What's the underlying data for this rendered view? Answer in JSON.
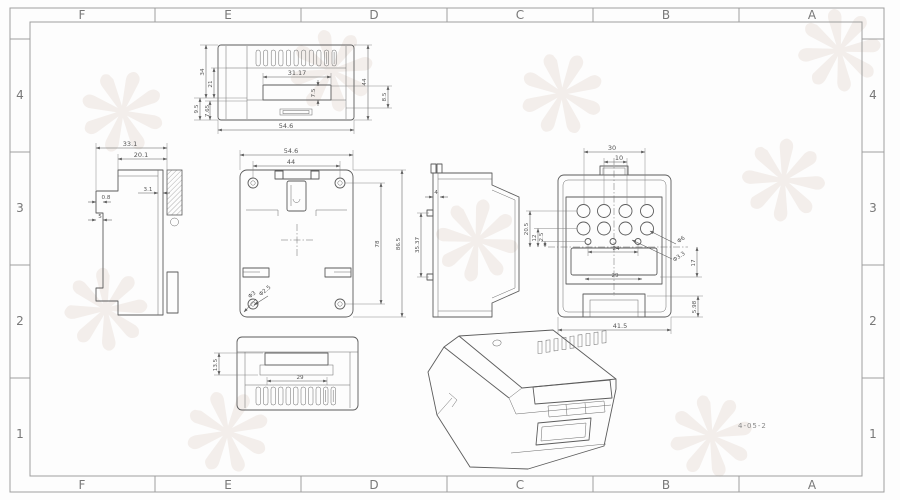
{
  "sheet": {
    "zones_h": [
      "F",
      "E",
      "D",
      "C",
      "B",
      "A"
    ],
    "zones_v": [
      "4",
      "3",
      "2",
      "1"
    ],
    "drawing_number": "4-05-2",
    "watermark_glyph": "❋",
    "colors": {
      "line": "#5c5c5c",
      "frame": "#9e9e9e",
      "watermark": "#f1ebe7",
      "background": "#fdfdfd"
    }
  },
  "views": {
    "top": {
      "label": "top-view",
      "w_outer": "54.6",
      "w_inner": "31.17",
      "h_right": "44",
      "right_small": "8.5",
      "left1": "34",
      "left2": "21",
      "left3": "9.5",
      "left4": "7.65",
      "slot": "7.5"
    },
    "side": {
      "label": "left-side-view",
      "w": "33.1",
      "w2": "20.1",
      "wall": "3.1",
      "step": "0.8",
      "d5": "5"
    },
    "rear": {
      "label": "rear-view",
      "w": "54.6",
      "w2": "44",
      "h_inner": "78",
      "h_outer": "86.5",
      "hole": "Φ3",
      "hole2": "Φ2.5"
    },
    "rail": {
      "label": "rail-profile-view",
      "d4": "4",
      "slot": "35.37"
    },
    "front": {
      "label": "front-view",
      "d30": "30",
      "d10": "10",
      "d20_5": "20.5",
      "d12": "12",
      "d2_5": "2.5",
      "d24": "24",
      "d29": "29",
      "d41_5": "41.5",
      "d5_98": "5.98",
      "d17": "17",
      "phi6": "Φ6",
      "phi3_3": "Φ3.3"
    },
    "bottom": {
      "label": "bottom-view",
      "d29": "29",
      "d13_5": "13.5"
    }
  }
}
